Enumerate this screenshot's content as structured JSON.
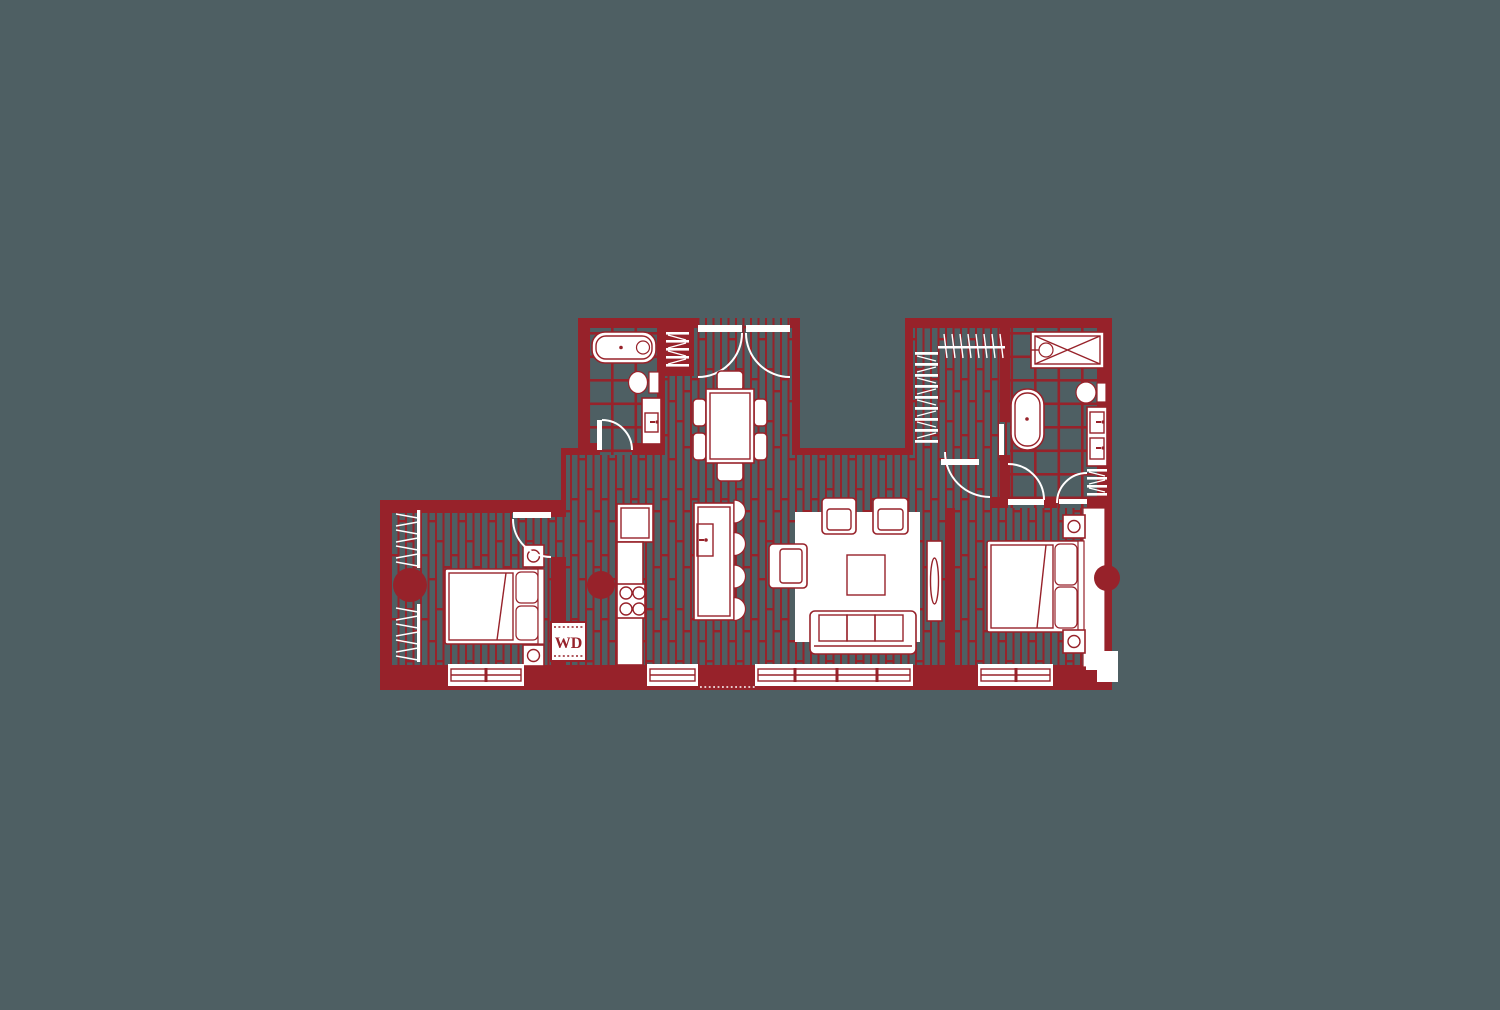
{
  "floor_plan": {
    "label_wd": "WD",
    "colors": {
      "background": "#4e5f63",
      "plan_red": "#97222a",
      "fixture_white": "#ffffff"
    },
    "fixtures": [
      "bathtub-icon",
      "toilet-icon",
      "vanity-sink-icon",
      "shower-icon",
      "freestanding-tub-icon",
      "double-vanity-icon",
      "dining-table-icon",
      "dining-chair-icon",
      "entry-double-door-icon",
      "refrigerator-icon",
      "cooktop-icon",
      "kitchen-counter-icon",
      "kitchen-island-icon",
      "bar-stool-icon",
      "sofa-icon",
      "armchair-icon",
      "coffee-table-icon",
      "tv-console-icon",
      "area-rug-icon",
      "bed-icon",
      "pillow-icon",
      "nightstand-icon",
      "washer-dryer-icon",
      "closet-hanging-rod-icon",
      "closet-shelves-icon",
      "linen-shelves-icon",
      "door-swing-icon",
      "window-icon",
      "structural-column-icon",
      "wood-floor-pattern",
      "tile-floor-pattern"
    ]
  }
}
